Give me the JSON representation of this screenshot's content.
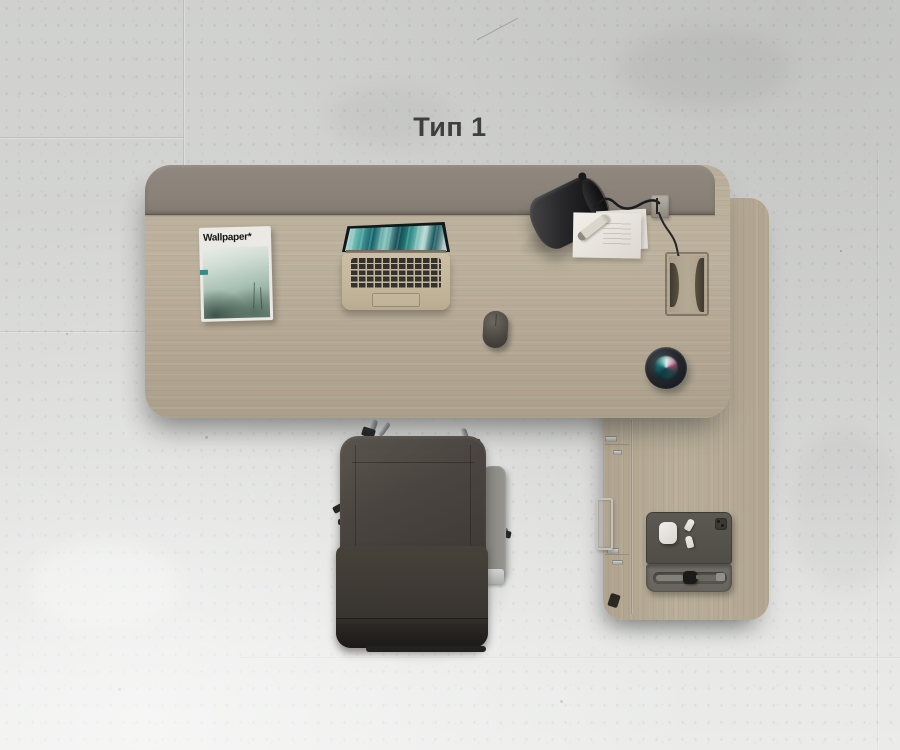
{
  "title": "Тип 1",
  "magazine": {
    "masthead": "Wallpaper*"
  },
  "scene": {
    "view": "top-down product render of office workstation type 1",
    "objects": [
      "main desk with taupe privacy panel",
      "return unit with side drawers",
      "office chair with cantilever chrome frame",
      "laptop with teal abstract wallpaper",
      "Wallpaper* magazine",
      "black desk lamp with clamp and cable",
      "paper sheets with pen",
      "computer mouse",
      "smart speaker",
      "cable grommet",
      "device tray with tablet, earbuds case, earbuds and smartwatch"
    ],
    "colors": {
      "floor": "#d3d4d2",
      "desk_wood": "#b7ab97",
      "privacy_panel": "#8b847a",
      "return_wood": "#b3a791",
      "chair_leather": "#46413c",
      "chair_armrest": "#8e8c88",
      "chrome": "#c9cccd",
      "lamp": "#1d1d1f",
      "laptop_body": "#c6b99e",
      "laptop_wallpaper_teal": "#116069",
      "speaker_ring": "#23262a",
      "speaker_display_teal": "#7fc8c2",
      "speaker_display_pink": "#dba8bd",
      "magazine_cover": "#9db5a9",
      "tray": "#5b5852",
      "title_text": "#3f3f3f"
    }
  }
}
